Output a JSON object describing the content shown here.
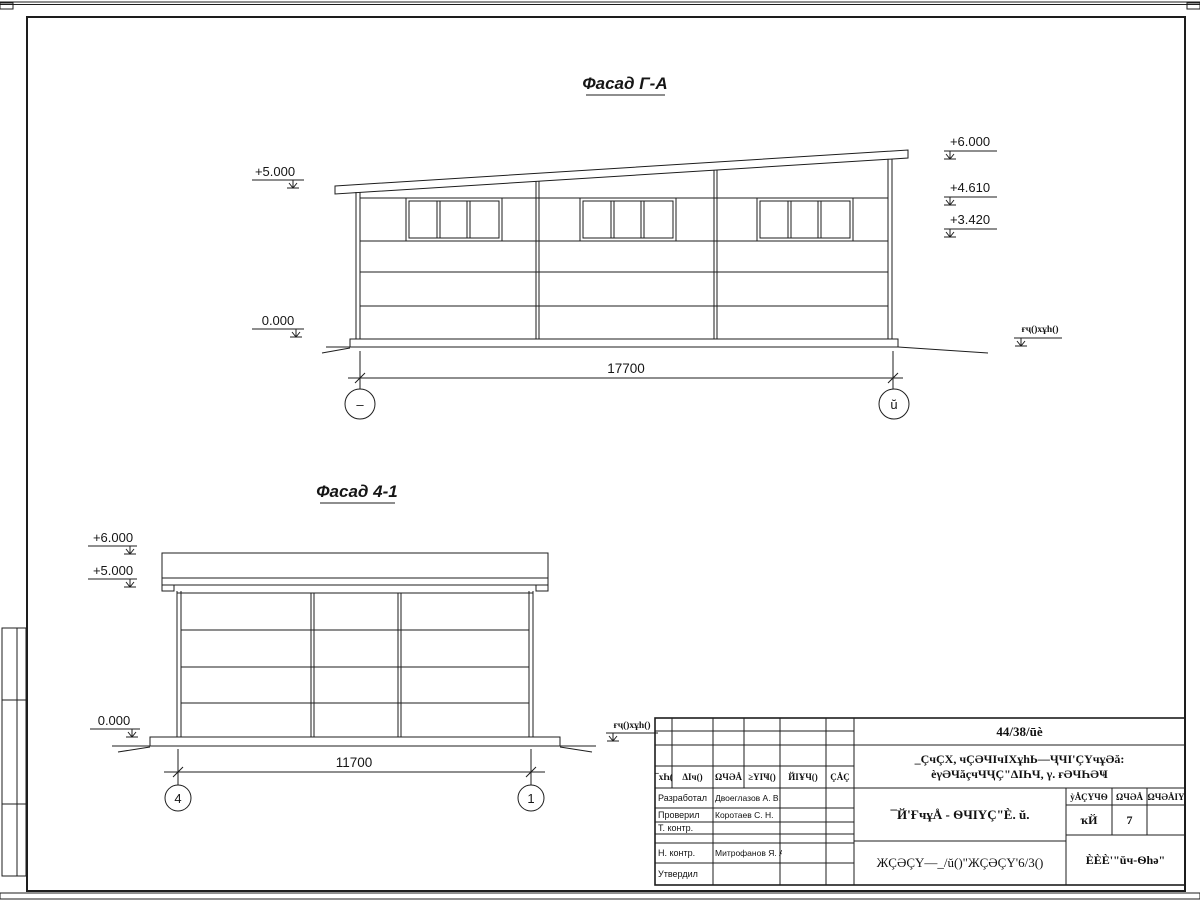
{
  "colors": {
    "ink": "#1d1d1d",
    "paper": "#ffffff"
  },
  "facade_ga": {
    "title": "Фасад Г-А",
    "dimension": "17700",
    "axis_left": "–",
    "axis_right": "ŭ",
    "elev_plus5": "+5.000",
    "elev_zero": "0.000",
    "elev_plus6": "+6.000",
    "elev_plus461": "+4.610",
    "elev_plus342": "+3.420",
    "ground_label": "ғҷ()хұh()"
  },
  "facade_41": {
    "title": "Фасад 4-1",
    "dimension": "11700",
    "axis_left": "4",
    "axis_right": "1",
    "elev_plus6": "+6.000",
    "elev_plus5": "+5.000",
    "elev_zero": "0.000",
    "ground_label": "ғҷ()хұh()"
  },
  "titleblock": {
    "doc_number": "44/38/ūè",
    "project_line1": "_ÇчÇХ, чÇӘЧIчIХұhЬ—ҶЧI'ÇҮчұӘă:",
    "project_line2": "èγӘЧăçчЧҶÇ\"ΔIҺЧ, γ. ғӘЧҺӘҸ",
    "sheet_name": "¯Й'ҒчұÅ - ѲЧIҮÇ\"È. ŭ.",
    "doc_code": "ЖÇӘÇҮ—_/ŭ()\"ЖÇӘÇҮ'6/3()",
    "company": "ÈÈÈ'\"ŭч-Ѳһә\"",
    "rev_headers": [
      "¯хҺ(",
      "ΔIч()",
      "ΩЧӘÅ",
      "≥YIҸ()",
      "ЙIҰЧ()",
      "ÇÅÇ"
    ],
    "stage_header": "ỳÅÇҮЧѲ",
    "sheet_header": "ΩЧӘÅ",
    "sheets_header": "ΩЧӘÅIҮ",
    "stage_value": "ҡЙ",
    "sheet_value": "7",
    "roles": [
      {
        "label": "Разработал",
        "name": "Двоеглазов А. В."
      },
      {
        "label": "Проверил",
        "name": "Коротаев С. Н."
      },
      {
        "label": "Т. контр.",
        "name": ""
      },
      {
        "label": "Н. контр.",
        "name": "Митрофанов Я. А."
      },
      {
        "label": "Утвердил",
        "name": ""
      }
    ]
  }
}
